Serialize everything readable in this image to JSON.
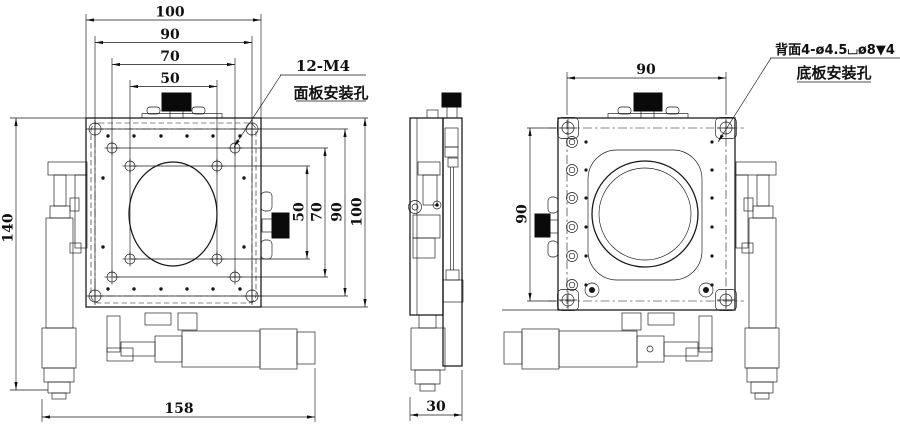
{
  "dims": {
    "front_top": [
      "100",
      "90",
      "70",
      "50"
    ],
    "front_right": [
      "50",
      "70",
      "90",
      "100"
    ],
    "front_left_height": "140",
    "front_total_width": "158",
    "side_width": "30",
    "back_top_width": "90",
    "back_left_height": "90"
  },
  "callouts": {
    "panel_holes_spec": "12-M4",
    "panel_holes_label": "面板安装孔",
    "base_holes_spec": "背面4-ø4.5⌴ø8▼4",
    "base_holes_label": "底板安装孔"
  },
  "colors": {
    "ink": "#161616",
    "background": "#ffffff",
    "knob": "#0a0a0a"
  }
}
